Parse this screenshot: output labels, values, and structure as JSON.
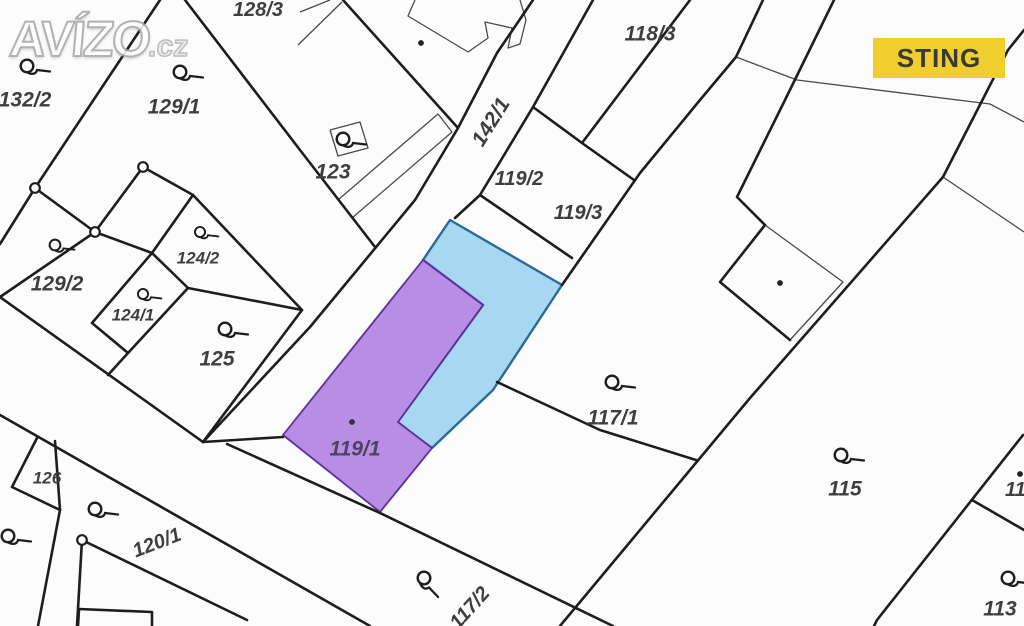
{
  "brand": {
    "watermark_main": "AVÍZO",
    "watermark_suffix": ".cz",
    "badge": "STING",
    "badge_bg": "#F1CE2F"
  },
  "map": {
    "background": "#fcfcfc",
    "line_color": "#1d1d1d",
    "thin_line_color": "#4a4a4a",
    "label_color": "#3e3e3e",
    "highlight_blue": {
      "parcel": "119 blue part",
      "fill": "#a7d7f1",
      "stroke": "#2a6a99",
      "points": "450,220 562,285 493,390 432,448 397,423 483,305 423,260"
    },
    "highlight_purple": {
      "parcel": "119/1",
      "fill": "#b78ee3",
      "stroke": "#5f2f9e",
      "points": "423,260 483,305 398,422 432,448 380,512 283,435"
    },
    "thick_lines": [
      "160,0 35,188",
      "35,188 0,244",
      "35,188 95,232 143,167 193,195",
      "95,232 0,297",
      "95,232 152,253",
      "193,195 152,253",
      "152,253 188,288 128,353 92,323 152,253",
      "128,353 108,375",
      "188,288 302,310",
      "193,195 302,310 203,442",
      "0,297 203,442",
      "185,0 300,150 375,247",
      "343,0 458,128",
      "533,0 497,53 458,128 415,200 310,327 203,442",
      "203,442 283,437",
      "593,0 533,107 480,195 455,218",
      "533,107 582,143 634,180",
      "690,0 582,143",
      "480,195 572,258",
      "763,0 736,57 700,100 640,173 562,285",
      "1024,30 1008,50 943,177",
      "943,177 750,398 560,626",
      "497,382 600,430 696,460",
      "227,444 380,513 613,626",
      "0,415 370,626",
      "37,438 12,487 60,510",
      "55,441 60,510 38,626",
      "82,540 77,626",
      "82,540 247,620",
      "78,626 79,609 152,612 152,626",
      "1023,435 877,620 874,626",
      "972,500 1024,530",
      "834,0 785,100 737,197 765,225",
      "765,225 720,282 790,340"
    ],
    "thin_lines": [
      "736,57 797,80 990,104 1024,122",
      "943,177 1024,232",
      "415,0 408,16 468,52 488,38 485,22 512,28 508,48 520,44 526,20 520,0",
      "338,200 352,218 452,132 438,114 338,200",
      "330,130 360,122 368,148 338,156 330,130",
      "300,12 330,0",
      "298,45 342,2",
      "765,225 843,282 790,340"
    ],
    "vertex_markers": [
      {
        "x": 35,
        "y": 188
      },
      {
        "x": 95,
        "y": 232
      },
      {
        "x": 143,
        "y": 167
      },
      {
        "x": 82,
        "y": 540
      }
    ],
    "dots": [
      {
        "x": 421,
        "y": 43,
        "c": "#222222"
      },
      {
        "x": 780,
        "y": 283,
        "c": "#222222"
      },
      {
        "x": 1020,
        "y": 474,
        "c": "#222222"
      },
      {
        "x": 352,
        "y": 422,
        "c": "#3b2d55"
      }
    ],
    "symbols": [
      {
        "x": 27,
        "y": 66
      },
      {
        "x": 180,
        "y": 72
      },
      {
        "x": 343,
        "y": 139
      },
      {
        "x": 55,
        "y": 245,
        "sc": 0.85
      },
      {
        "x": 200,
        "y": 232,
        "sc": 0.8
      },
      {
        "x": 143,
        "y": 294,
        "sc": 0.8
      },
      {
        "x": 225,
        "y": 329
      },
      {
        "x": 612,
        "y": 382
      },
      {
        "x": 841,
        "y": 455
      },
      {
        "x": 95,
        "y": 509
      },
      {
        "x": 8,
        "y": 536
      },
      {
        "x": 1008,
        "y": 578
      },
      {
        "x": 424,
        "y": 578,
        "r": 40
      }
    ],
    "parcel_labels": [
      {
        "t": "132/2",
        "x": 25,
        "y": 100,
        "s": 21
      },
      {
        "t": "129/1",
        "x": 174,
        "y": 107,
        "s": 21
      },
      {
        "t": "128/3",
        "x": 258,
        "y": 10,
        "s": 20
      },
      {
        "t": "123",
        "x": 333,
        "y": 172,
        "s": 21
      },
      {
        "t": "142/1",
        "x": 491,
        "y": 122,
        "s": 21,
        "r": -58
      },
      {
        "t": "119/2",
        "x": 519,
        "y": 179,
        "s": 20
      },
      {
        "t": "119/3",
        "x": 578,
        "y": 213,
        "s": 20
      },
      {
        "t": "118/3",
        "x": 650,
        "y": 34,
        "s": 21
      },
      {
        "t": "129/2",
        "x": 57,
        "y": 284,
        "s": 21
      },
      {
        "t": "124/2",
        "x": 198,
        "y": 258,
        "s": 17
      },
      {
        "t": "124/1",
        "x": 133,
        "y": 315,
        "s": 17
      },
      {
        "t": "125",
        "x": 217,
        "y": 359,
        "s": 21
      },
      {
        "t": "126",
        "x": 47,
        "y": 478,
        "s": 17
      },
      {
        "t": "120/1",
        "x": 157,
        "y": 543,
        "s": 20,
        "r": -21
      },
      {
        "t": "117/1",
        "x": 613,
        "y": 418,
        "s": 21
      },
      {
        "t": "115",
        "x": 845,
        "y": 489,
        "s": 21
      },
      {
        "t": "113",
        "x": 1000,
        "y": 609,
        "s": 21
      },
      {
        "t": "114",
        "x": 1021,
        "y": 490,
        "s": 20
      },
      {
        "t": "117/2",
        "x": 470,
        "y": 608,
        "s": 20,
        "r": -48
      },
      {
        "t": "119/1",
        "x": 355,
        "y": 449,
        "s": 21,
        "c": "#4d4166"
      }
    ]
  }
}
